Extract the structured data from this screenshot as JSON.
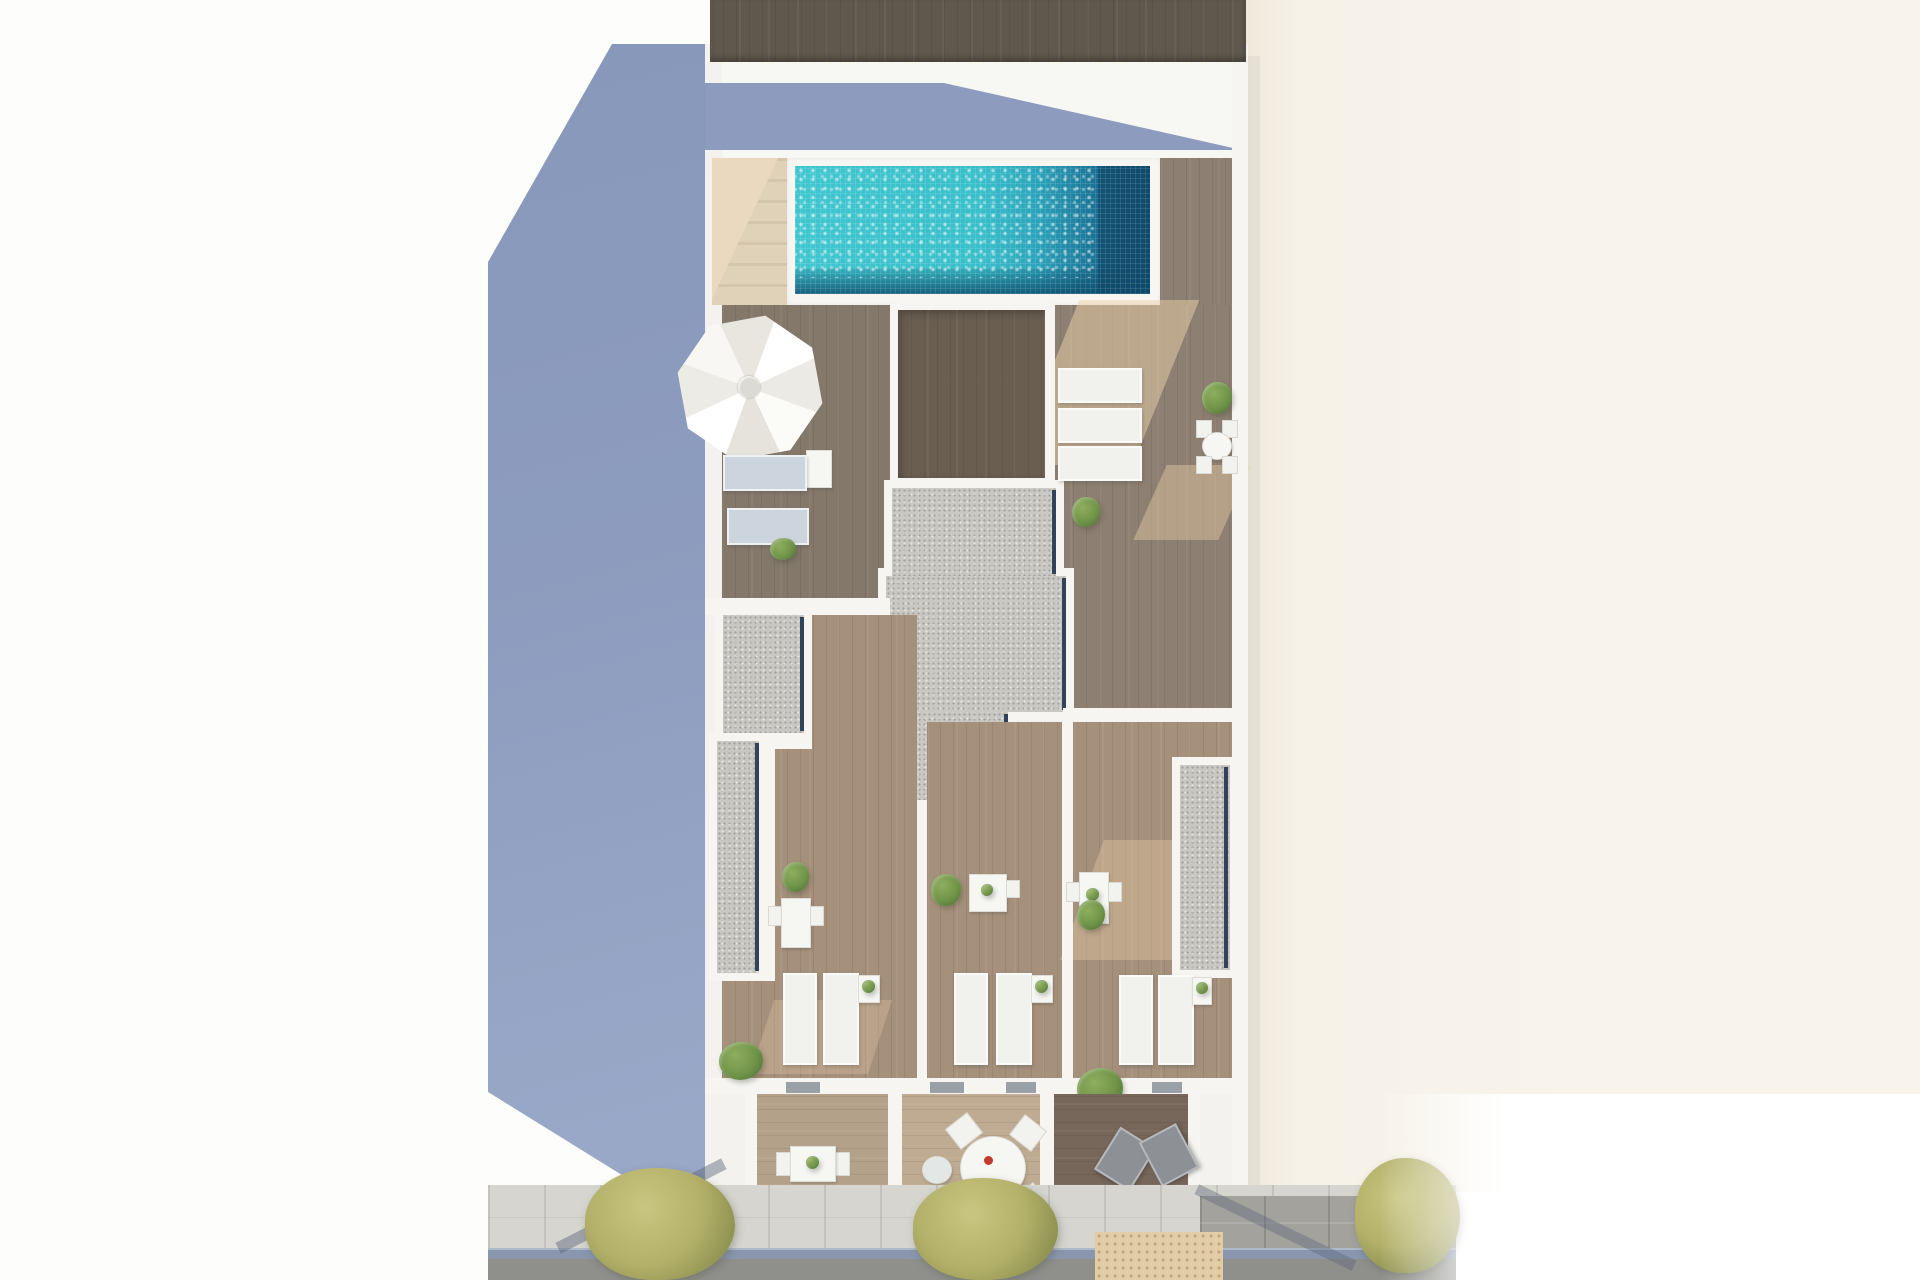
{
  "scene": {
    "type": "architectural-aerial-render",
    "description": "Top-down 3D rendering of a residential building rooftop: lap pool with turquoise tiled water, wooden deck terraces, white parasol with sun loungers, granite skylight block, three private terraces with loungers and dining sets, lower balconies with furniture, street with sidewalk, trees and road below, shaded neighbouring roof in blue at left, cream party-wall at right",
    "areas": [
      "neighbour-shadow-roof",
      "rooftop-pool-terrace",
      "umbrella-lounge-court",
      "private-terrace-left",
      "private-terrace-middle",
      "private-terrace-right",
      "lower-balconies",
      "street"
    ]
  },
  "palette": {
    "bg_white": "#fdfdfb",
    "shadow_blue": "#8d9cbe",
    "shadow_blue_light": "#9aa8c8",
    "cream": "#f6f2e8",
    "cream_edge": "#efe8da",
    "wall_white": "#f6f5f1",
    "slab_white": "#f3f2ee",
    "roof_dark": "#5f584d",
    "pool_light": "#3fc6cf",
    "pool_mid": "#2ba4bb",
    "pool_deep": "#17688c",
    "pool_shadow": "#0f4e70",
    "coping": "#f7f6f3",
    "stair_light": "#ead9be",
    "stair_dark": "#d5c5ab",
    "deck": "#8d7f71",
    "deck_dark": "#7f7367",
    "deck_light": "#a5907b",
    "deck_pale": "#e8cfa9",
    "dark_block": "#6a5e51",
    "granite": "#c9c8c3",
    "gravel": "#c8c7c2",
    "glass_navy": "#31425b",
    "lounger_white": "#f1f1ee",
    "lounger_blue": "#ccd4dd",
    "green_bush": "#6f9448",
    "green_dark": "#55763a",
    "olive": "#b3b069",
    "olive_dark": "#8d9150",
    "room_wood": "#b4a18a",
    "room_wood_mid": "#bfab92",
    "room_wood_dark": "#77665a",
    "sidewalk": "#d6d5d0",
    "slab_wall": "#a3a29d",
    "curb": "#8996ae",
    "road": "#8f8f8c",
    "tactile": "#e3cda6",
    "decor_red": "#c23b2e"
  }
}
